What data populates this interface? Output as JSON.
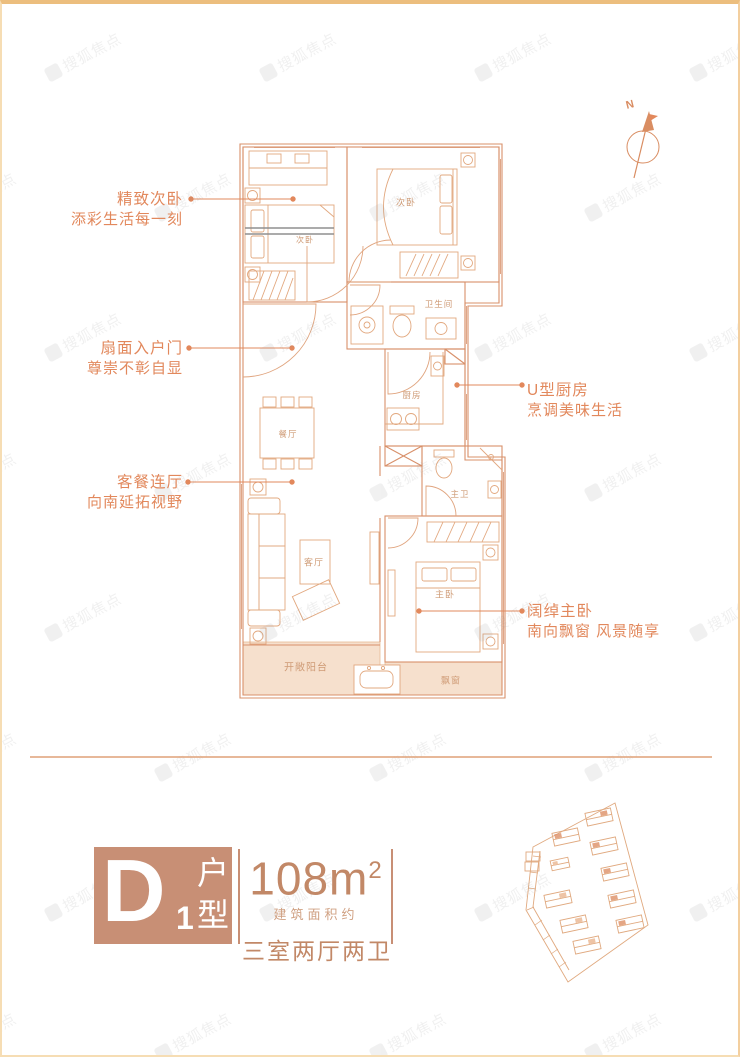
{
  "watermark": {
    "text": "搜狐焦点"
  },
  "compass": {
    "label": "N"
  },
  "plan": {
    "room_labels": {
      "bedroom_left": "次卧",
      "bedroom_right": "次卧",
      "bathroom": "卫生间",
      "kitchen": "厨房",
      "dining": "餐厅",
      "living": "客厅",
      "master_bath": "主卫",
      "master_bedroom": "主卧",
      "balcony": "开敞阳台",
      "bay_window": "飘窗"
    },
    "annotations": {
      "second_bedroom": {
        "line1": "精致次卧",
        "line2": "添彩生活每一刻"
      },
      "entry_door": {
        "line1": "扇面入户门",
        "line2": "尊崇不彰自显"
      },
      "living_dining": {
        "line1": "客餐连厅",
        "line2": "向南延拓视野"
      },
      "kitchen": {
        "line1": "U型厨房",
        "line2": "烹调美味生活"
      },
      "master_bedroom": {
        "line1": "阔绰主卧",
        "line2": "南向飘窗 风景随享"
      }
    }
  },
  "info": {
    "unit_letter": "D",
    "unit_number": "1",
    "type_char_top": "户",
    "type_char_bottom": "型",
    "area": "108m",
    "area_sup": "2",
    "area_caption": "建筑面积约",
    "layout_summary": "三室两厅两卫"
  },
  "colors": {
    "accent": "#c88f75",
    "plan_line": "#d8906a",
    "annotation_text": "#e2885c",
    "frame_border": "#ecbe7e"
  }
}
